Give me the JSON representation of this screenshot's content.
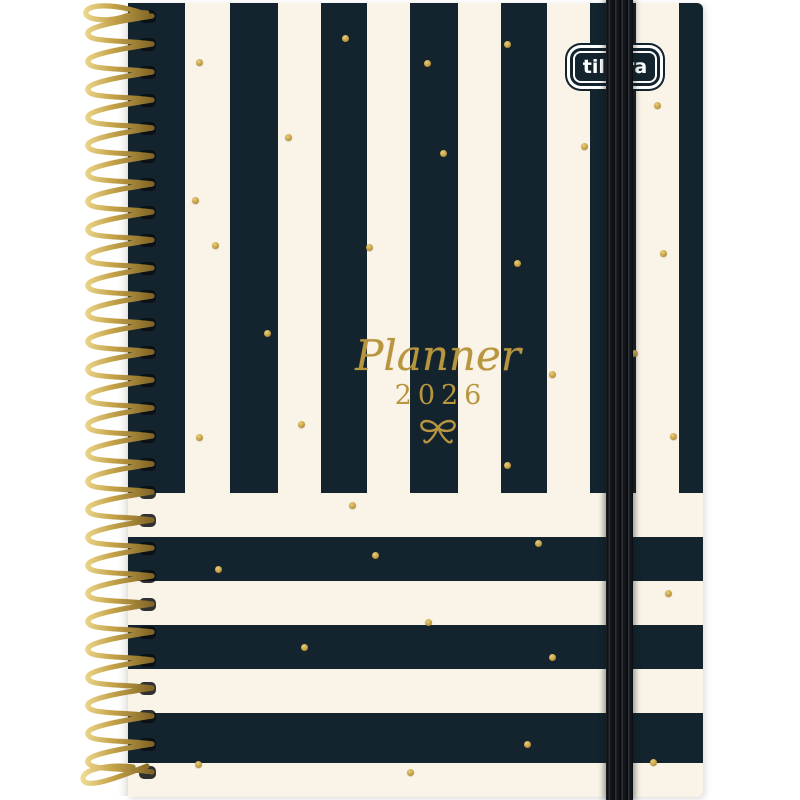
{
  "brand": {
    "logo_text": "tilibra"
  },
  "cover": {
    "title_script": "Planner",
    "year": "2026",
    "bow_icon": "gold-bow-icon"
  },
  "colors": {
    "stripe_dark": "#13242e",
    "stripe_cream": "#faf4e8",
    "gold": "#b8953f",
    "gold_highlight": "#e8d07c",
    "elastic_black": "#131518",
    "spiral_wire_gold": "#b59238",
    "page_background": "#ffffff"
  },
  "gold_dots": [
    {
      "x": 199,
      "y": 62
    },
    {
      "x": 345,
      "y": 38
    },
    {
      "x": 427,
      "y": 63
    },
    {
      "x": 507,
      "y": 44
    },
    {
      "x": 657,
      "y": 105
    },
    {
      "x": 288,
      "y": 137
    },
    {
      "x": 443,
      "y": 153
    },
    {
      "x": 584,
      "y": 146
    },
    {
      "x": 195,
      "y": 200
    },
    {
      "x": 215,
      "y": 245
    },
    {
      "x": 369,
      "y": 247
    },
    {
      "x": 517,
      "y": 263
    },
    {
      "x": 663,
      "y": 253
    },
    {
      "x": 267,
      "y": 333
    },
    {
      "x": 552,
      "y": 374
    },
    {
      "x": 634,
      "y": 353
    },
    {
      "x": 673,
      "y": 436
    },
    {
      "x": 199,
      "y": 437
    },
    {
      "x": 301,
      "y": 424
    },
    {
      "x": 507,
      "y": 465
    },
    {
      "x": 352,
      "y": 505
    },
    {
      "x": 538,
      "y": 543
    },
    {
      "x": 375,
      "y": 555
    },
    {
      "x": 218,
      "y": 569
    },
    {
      "x": 668,
      "y": 593
    },
    {
      "x": 428,
      "y": 622
    },
    {
      "x": 304,
      "y": 647
    },
    {
      "x": 552,
      "y": 657
    },
    {
      "x": 527,
      "y": 744
    },
    {
      "x": 198,
      "y": 764
    },
    {
      "x": 410,
      "y": 772
    },
    {
      "x": 653,
      "y": 762
    }
  ]
}
